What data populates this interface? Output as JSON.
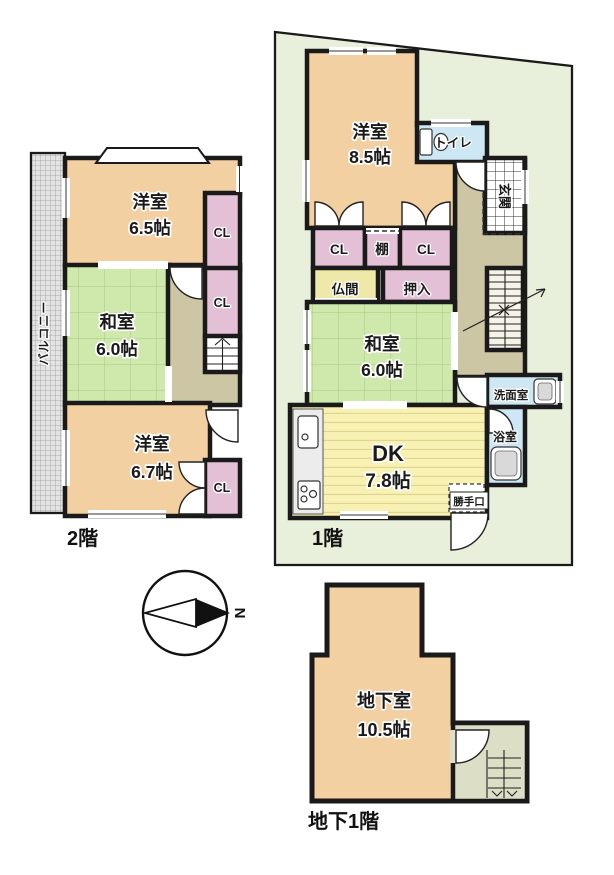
{
  "floor2": {
    "label": "2階",
    "balcony": "バルコニー",
    "rooms": {
      "west1": {
        "name": "洋室",
        "size": "6.5帖"
      },
      "japanese": {
        "name": "和室",
        "size": "6.0帖"
      },
      "west2": {
        "name": "洋室",
        "size": "6.7帖"
      },
      "closet1": "CL",
      "closet2": "CL",
      "closet3": "CL"
    }
  },
  "floor1": {
    "label": "1階",
    "rooms": {
      "west": {
        "name": "洋室",
        "size": "8.5帖"
      },
      "toilet": "トイレ",
      "entrance": "玄関",
      "closet1": "CL",
      "shelf": "棚",
      "closet2": "CL",
      "altar_room": "仏間",
      "futon_closet": "押入",
      "japanese": {
        "name": "和室",
        "size": "6.0帖"
      },
      "dining_kitchen": {
        "name": "DK",
        "size": "7.8帖"
      },
      "washroom": "洗面室",
      "bathroom": "浴室",
      "back_door": "勝手口"
    }
  },
  "basement": {
    "label": "地下1階",
    "rooms": {
      "cellar": {
        "name": "地下室",
        "size": "10.5帖"
      }
    }
  },
  "compass": {
    "north_label": "N"
  },
  "colors": {
    "wall": "#1a1a1a",
    "western_room": "#f3d0a2",
    "closet_pink": "#e4c0d6",
    "wet_blue": "#cde8f4",
    "hall_olive": "#ccc6a4",
    "lot_green": "#e8efda",
    "altar_yellow": "#eee9a8",
    "stair_floor": "#f6f4e8",
    "annex_floor": "#dcdec5"
  }
}
